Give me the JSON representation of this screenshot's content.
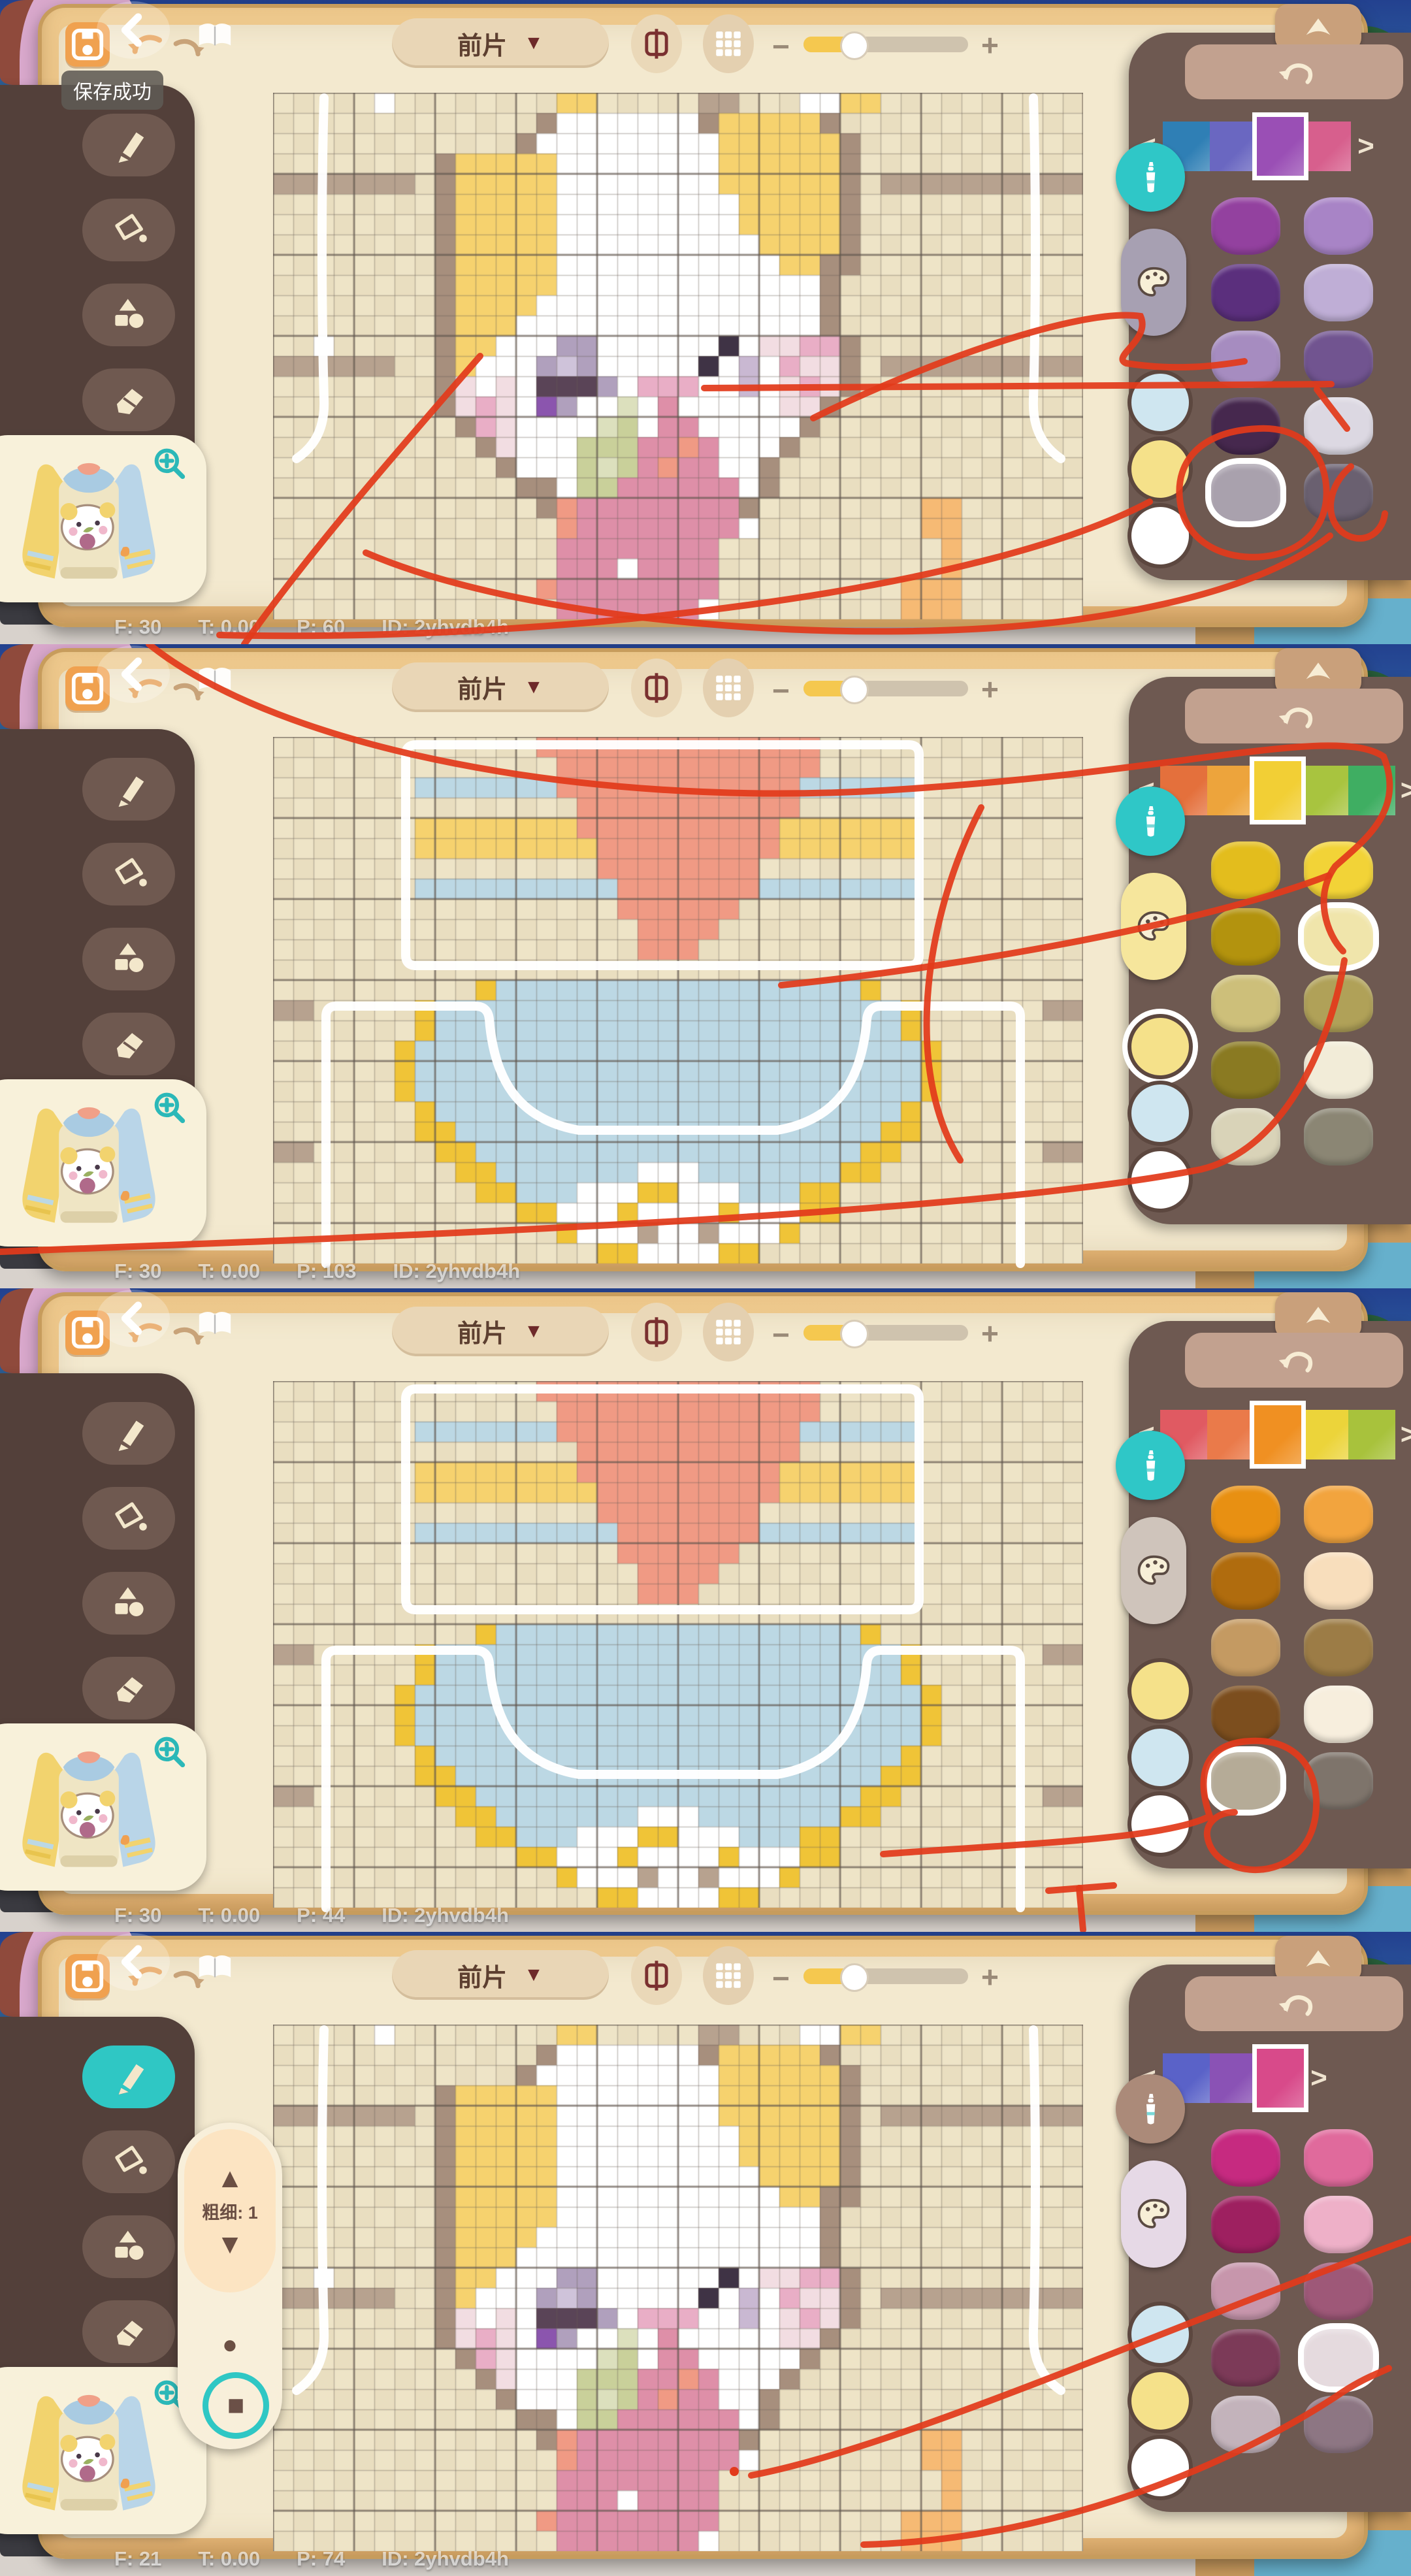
{
  "labels": {
    "piece": "前片",
    "save_success": "保存成功",
    "size": "粗细: 1",
    "zoom_out": "−",
    "zoom_in": "+",
    "prev": "<",
    "next": ">",
    "caret": "▼",
    "up": "▲",
    "down": "▼",
    "dot": "●",
    "square": "■"
  },
  "colors": {
    "accent_teal": "#2fc7c4",
    "annotation_red": "#e23a1b",
    "wood": "#e2b375",
    "panel_brown": "#6e5951",
    "toolbar_brown": "#53403a",
    "sheet_cream": "#f3e9cf"
  },
  "checker": {
    "a": "#eee4c7",
    "b": "#e9dec0",
    "grid_minor": "rgba(108,98,90,0.38)",
    "grid_major": "rgba(94,84,76,0.58)"
  },
  "legend": {
    "b": "#b7a28f",
    "w": "#ffffff",
    "W": "#ffffff",
    "T": "#a78f7d",
    "Y": "#f6d26e",
    "L": "#cfc3da",
    "M": "#b0a0bd",
    "D": "#5a4457",
    "E": "#3f3345",
    "V": "#8b55ae",
    "x": "#f2dde2",
    "P": "#e9aec6",
    "R": "#de8fa8",
    "S": "#f09a84",
    "G": "#c9d09a",
    "g": "#dce0bd",
    "O": "#f6ba74",
    "m": "#c9b8d2",
    "B": "#bcd8e4",
    "y": "#f0c437"
  },
  "designs": {
    "face": [
      ".....w........YY.....bb...wwYY..........",
      ".............TWWWWWWWTYYYYYT............",
      "............TWWWWWWWWWYYYYYYT...........",
      "........TYYYYYWWWWWWWWYYYYYYT...........",
      "bbbbbbb.TYYYYYWWWWWWWWYYYYYYT.bbbbbbbbbb",
      "........TYYYYYWWWWWWWWWYYYYYT...........",
      "........TYYYYYWWWWWWWWWYYYYYT...........",
      "........TYYYYYWWWWWWWWWWYYYYT...........",
      "........TYYYYYWWWWWWWWWWWYYTT...........",
      "........TYYYYYWWWWWWWWWWWWWT............",
      "........TYYYYWWWWWWWWWWWWWWT............",
      "........TYYYWWWWWWWWWWWWWWWT............",
      "..w.....TYYWWWMMWWWWWWEWxxPPT...........",
      "bbbbbb..TYWWWMLMWWWWWEWmWPxxT.bbbbbbbbbb",
      "........TxWxWDDDMWPPPWWmWxPxT...........",
      "........TxPxWVMWWgWRWWWWWxxT............",
      ".........TPxWWWWgGWRRWWWWWT.............",
      "..........TxWWWGGGRRSRWWWT..............",
      "...........TWWWGgGRSRRWWT...............",
      "............TTWGGRRRRRRWT...............",
      ".............TSRRRRRRRRT........OO......",
      "..............SRRRRRRRRw........OO......",
      "..............RRRRRRRR...........O......",
      "..............RRRWRRRR...........O......",
      ".............SRRRRRRRR.........OOO......",
      "..............RRRRRRRw.........OOO......"
    ],
    "shirt": [
      ".............SSSSSSSSSSSSSS.............",
      "..............SSSSSSSSSSSSS.............",
      ".......BBBBBBBSSSSSSSSSSSSBBBBBB........",
      "...............SSSSSSSSSSS..............",
      ".......YYYYYYYYSSSSSSSSSSYYYYYYY........",
      ".......YYYYYYYYYSSSSSSSSSYYYYYYY........",
      "................SSSSSSSS................",
      ".......BBBBBBBBBBSSSSSSSBBBBBBBB........",
      ".................SSSSSS.................",
      "..................SSSS..................",
      "..................SSS...................",
      "........................................",
      "..........yBBBBBBBBBBBBBBBBBBy..........",
      "bb.....yBBBBBBBBBBBBBBBBBBBBBBBy......bb",
      ".......yBBBBBBBBBBBBBBBBBBBBBBBy........",
      "......yBBBBBBBBBBBBBBBBBBBBBBBBBy.......",
      "......yBBBBBBBBBBBBBBBBBBBBBBBBBy.......",
      "......yBBBBBBBBBBBBBBBBBBBBBBBBBy.......",
      ".......yBBBBBBBBBBBBBBBBBBBBBBBy........",
      ".......yyBBBBBBBBBBBBBBBBBBBBByy........",
      "bb......yyBBBBBBBBBBBBBBBBBBByy.......bb",
      ".........yyBBBBBBBWWWBBBBBBByy..........",
      "..........yyBBBWWWyyWWWBBByy............",
      "............yyWWWyWWWWyWWWyy............",
      "..............yWWWbWWbWWWy..............",
      "................yyWWWWyy................"
    ]
  },
  "overlays": {
    "face": [
      "M78 8 C74 150 74 320 78 470 C80 520 58 545 36 560",
      "M1164 8 C1168 150 1168 320 1164 470 C1162 520 1184 545 1206 560"
    ],
    "shirt": [
      "M219 12 L973 12 Q989 12 989 28 L989 334 Q989 350 973 350 L219 350 Q203 350 203 334 L203 28 Q203 12 219 12",
      "M81 806 L81 428 Q81 412 97 412 L309 412 Q329 412 331 432 C338 520 372 585 468 602 L772 602 C868 585 902 520 909 432 Q911 412 931 412 L1128 412 Q1144 412 1144 428 L1144 806"
    ]
  },
  "panels": [
    {
      "status": {
        "frames": "F: 30",
        "time": "T: 0.00",
        "points": "P: 60",
        "id": "ID: 2yhvdb4h"
      },
      "design": "face",
      "show_save_tooltip": true,
      "active_tool": null,
      "show_pen_popout": false,
      "palette": {
        "bottle_bg": "#2fc7c7",
        "palette_bg": "#a7a0b2",
        "strip": [
          "#2f7fb5",
          "#6a67c1",
          "#9a4fb5",
          "#d75f8d"
        ],
        "strip_selected": 2,
        "circles": [
          "#cfe6f0",
          "#f5e18a",
          "#ffffff"
        ],
        "circle_ring": null,
        "swatches": [
          [
            "#93419f",
            "#a884c6"
          ],
          [
            "#5b2f7d",
            "#bfaed6"
          ],
          [
            "#a68cc0",
            "#715490"
          ],
          [
            "#46284e",
            "#dcd8e2"
          ],
          [
            "#a9a1ad",
            "#6a6070"
          ]
        ],
        "selected": [
          4,
          0
        ]
      },
      "annotations": [
        "M735 545 C600 700 468 852 374 986",
        "M1245 640 C1410 558 1652 470 1746 484 C1762 520 1700 546 1724 556 C1800 568 1862 560 1905 553",
        "M1078 594 L2038 588",
        "M2016 596 L2062 656",
        "M1926 656 C1838 660 1800 706 1806 764 C1812 830 1874 858 1934 852 C2000 845 2036 800 2030 742 C2024 684 1984 653 1926 656",
        "M2068 714 C2034 742 2026 790 2054 814 C2082 836 2116 820 2120 786",
        "M560 846 C820 958 1320 988 1620 952 C1830 926 1962 878 2036 820",
        "M1760 768 C1500 906 850 984 336 972"
      ]
    },
    {
      "status": {
        "frames": "F: 30",
        "time": "T: 0.00",
        "points": "P: 103",
        "id": "ID: 2yhvdb4h"
      },
      "design": "shirt",
      "show_save_tooltip": false,
      "active_tool": null,
      "show_pen_popout": false,
      "palette": {
        "bottle_bg": "#2fc7c7",
        "palette_bg": "#f6e69c",
        "strip": [
          "#e4703c",
          "#eda43c",
          "#f2cf35",
          "#a8c43f",
          "#3fae62"
        ],
        "strip_selected": 2,
        "circles": [
          "#f5e18a",
          "#cfe6f0",
          "#ffffff"
        ],
        "circle_ring": 0,
        "swatches": [
          [
            "#e3bd1d",
            "#f2d337"
          ],
          [
            "#b3930e",
            "#f0e5ab"
          ],
          [
            "#cdbf7a",
            "#b0a158"
          ],
          [
            "#8a7a22",
            "#f2ecd8"
          ],
          [
            "#d9d3b8",
            "#8b8674"
          ]
        ],
        "selected": [
          1,
          1
        ]
      },
      "annotations": [
        "M228 0 C430 162 900 250 1350 224 C1800 198 2042 122 2118 172 C2152 256 2086 302 2044 340 C2010 386 2032 446 2056 470",
        "M1502 250 C1408 432 1388 662 1470 790",
        "M1196 522 C1452 496 1832 432 2034 354",
        "M0 930 C620 906 1482 874 1838 804 C1974 772 2040 594 2058 484"
      ]
    },
    {
      "status": {
        "frames": "F: 30",
        "time": "T: 0.00",
        "points": "P: 44",
        "id": "ID: 2yhvdb4h"
      },
      "design": "shirt",
      "show_save_tooltip": false,
      "active_tool": null,
      "show_pen_popout": false,
      "palette": {
        "bottle_bg": "#2fc7c7",
        "palette_bg": "#cfc4bb",
        "strip": [
          "#e05a62",
          "#ea7a4a",
          "#f09022",
          "#ecd43a",
          "#a8c23c"
        ],
        "strip_selected": 2,
        "circles": [
          "#f5e18a",
          "#cfe6f0",
          "#ffffff"
        ],
        "circle_ring": null,
        "swatches": [
          [
            "#e89012",
            "#f2a43e"
          ],
          [
            "#b06c0e",
            "#f8debc"
          ],
          [
            "#c49a62",
            "#9c7c46"
          ],
          [
            "#7c4e1e",
            "#f7eedd"
          ],
          [
            "#b5ab97",
            "#7e746b"
          ]
        ],
        "selected": [
          4,
          0
        ]
      },
      "annotations": [
        "M1605 922 L1705 914",
        "M1652 918 L1658 982",
        "M1352 866 C1560 850 1782 844 1852 808 C1830 744 1846 702 1902 694 C1974 685 2012 724 2015 782 C2018 852 1972 892 1918 890 C1880 888 1852 868 1848 838 C1846 820 1862 802 1890 802"
      ]
    },
    {
      "status": {
        "frames": "F: 21",
        "time": "T: 0.00",
        "points": "P: 74",
        "id": "ID: 2yhvdb4h"
      },
      "design": "face",
      "show_save_tooltip": false,
      "active_tool": 0,
      "show_pen_popout": true,
      "red_dot": [
        1124,
        826
      ],
      "palette": {
        "bottle_bg": "#ab8a79",
        "palette_bg": "#e6d9e6",
        "strip": [
          "#5a62c8",
          "#8a52b5",
          "#d84a8a"
        ],
        "strip_selected": 2,
        "circles": [
          "#cfe6f0",
          "#f5e18a",
          "#ffffff"
        ],
        "circle_ring": null,
        "swatches": [
          [
            "#c62a80",
            "#e06a9c"
          ],
          [
            "#9e2060",
            "#eeb0c8"
          ],
          [
            "#c796ac",
            "#9e5878"
          ],
          [
            "#7c3a58",
            "#e5dade"
          ],
          [
            "#c3b3bb",
            "#8d7683"
          ]
        ],
        "selected": [
          3,
          1
        ]
      },
      "annotations": [
        "M1150 832 C1380 788 1768 612 2160 470",
        "M1322 938 C1642 930 1920 796 2056 704 C2090 682 2110 676 2126 668"
      ]
    }
  ]
}
